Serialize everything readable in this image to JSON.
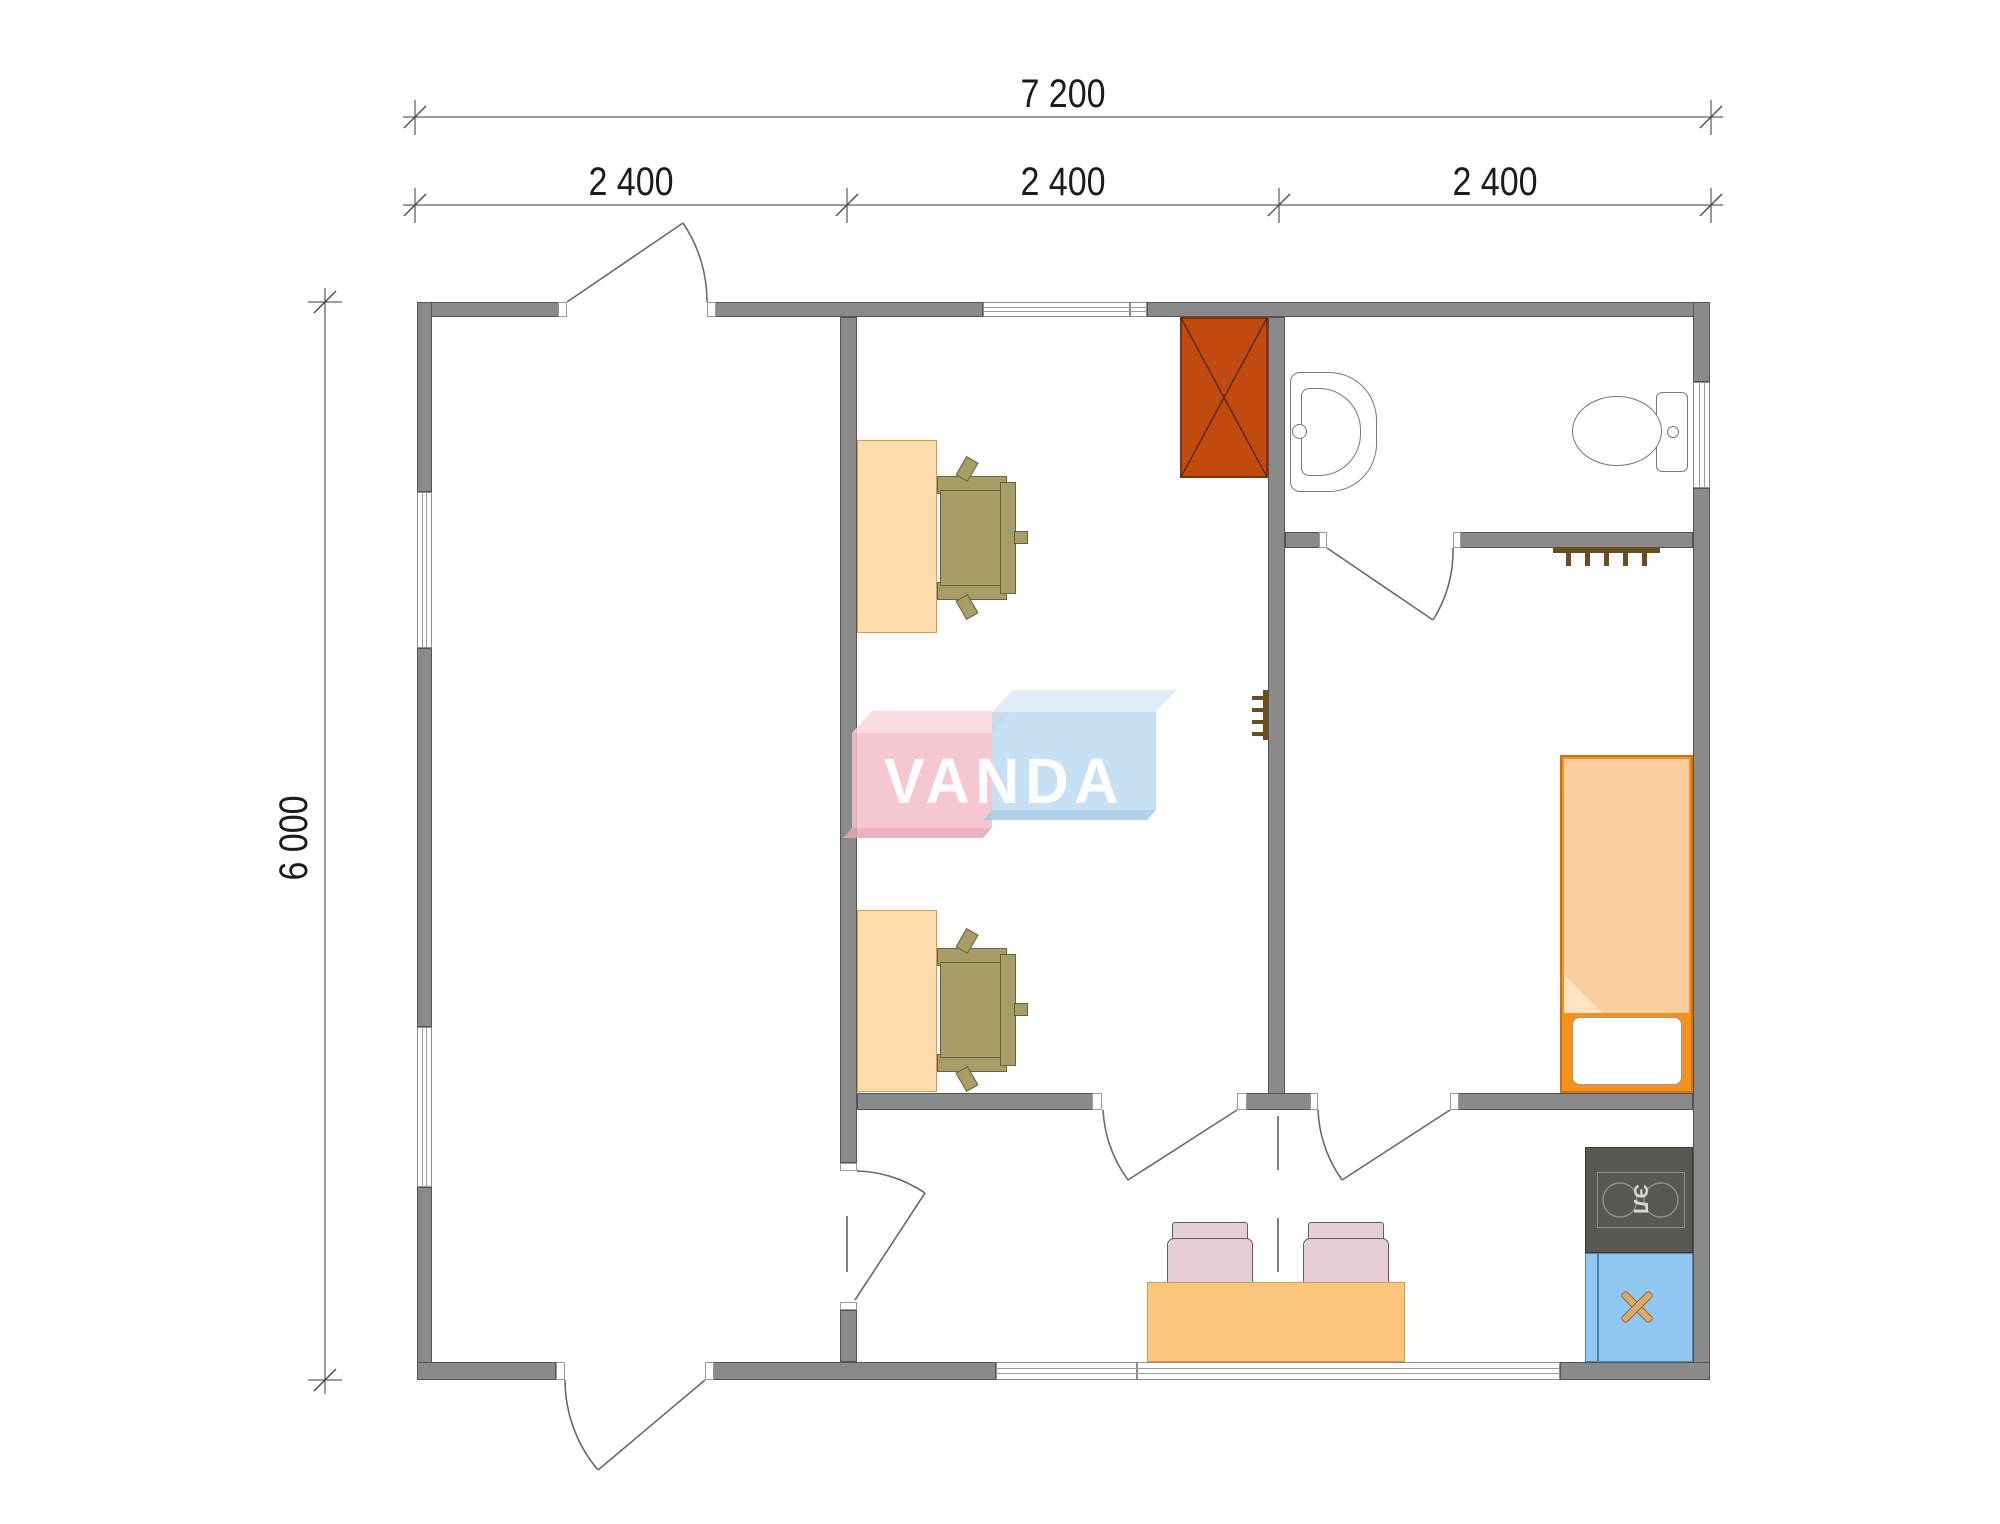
{
  "dimensions": {
    "overall_width": "7 200",
    "bay_1": "2 400",
    "bay_2": "2 400",
    "bay_3": "2 400",
    "overall_height": "6 000"
  },
  "logo": {
    "text": "VANDA",
    "pink": "#F3BDC9",
    "blue": "#BEDAF2"
  },
  "kitchen": {
    "stove_label": "ЭЛ"
  },
  "colors": {
    "wall": "#8A8A8A",
    "wardrobe": "#C14B0E",
    "desk": "#FCDCAB",
    "chair": "#A79D66",
    "bed_frame": "#F5921E",
    "blanket": "#FBCF9D",
    "table": "#FBC57E",
    "dining_chair": "#E6CED6",
    "stove": "#5B5753",
    "sink_cabinet": "#90C8F2"
  },
  "geometry": {
    "rects": [
      {
        "n": "top-wall-left",
        "c": "wall",
        "x": 417,
        "y": 302,
        "w": 150,
        "h": 15
      },
      {
        "n": "top-wall-mid",
        "c": "wall",
        "x": 707,
        "y": 302,
        "w": 276,
        "h": 15
      },
      {
        "n": "top-wall-right",
        "c": "wall",
        "x": 1147,
        "y": 302,
        "w": 563,
        "h": 15
      },
      {
        "n": "left-wall-top",
        "c": "wall",
        "x": 417,
        "y": 302,
        "w": 15,
        "h": 190
      },
      {
        "n": "left-wall-mid",
        "c": "wall",
        "x": 417,
        "y": 648,
        "w": 15,
        "h": 379
      },
      {
        "n": "left-wall-bottom",
        "c": "wall",
        "x": 417,
        "y": 1187,
        "w": 15,
        "h": 193
      },
      {
        "n": "right-wall-top",
        "c": "wall",
        "x": 1693,
        "y": 302,
        "w": 17,
        "h": 80
      },
      {
        "n": "right-wall-main",
        "c": "wall",
        "x": 1693,
        "y": 488,
        "w": 17,
        "h": 892
      },
      {
        "n": "bottom-wall-left",
        "c": "wall",
        "x": 417,
        "y": 1362,
        "w": 139,
        "h": 18
      },
      {
        "n": "bottom-wall-mid",
        "c": "wall",
        "x": 705,
        "y": 1362,
        "w": 291,
        "h": 18
      },
      {
        "n": "bottom-wall-right",
        "c": "wall",
        "x": 1560,
        "y": 1362,
        "w": 150,
        "h": 18
      },
      {
        "n": "hall-partition-wall",
        "c": "wall",
        "x": 840,
        "y": 317,
        "w": 17,
        "h": 846
      },
      {
        "n": "hall-partition-stub",
        "c": "wall",
        "x": 840,
        "y": 1310,
        "w": 17,
        "h": 52
      },
      {
        "n": "bedroom-partition-wall",
        "c": "wall",
        "x": 1268,
        "y": 317,
        "w": 17,
        "h": 793
      },
      {
        "n": "mid-wall-left",
        "c": "wall",
        "x": 857,
        "y": 1093,
        "w": 245,
        "h": 17
      },
      {
        "n": "mid-wall-center",
        "c": "wall",
        "x": 1237,
        "y": 1093,
        "w": 81,
        "h": 17
      },
      {
        "n": "mid-wall-right",
        "c": "wall",
        "x": 1450,
        "y": 1093,
        "w": 243,
        "h": 17
      },
      {
        "n": "bath-wall-left",
        "c": "wall",
        "x": 1285,
        "y": 532,
        "w": 42,
        "h": 16
      },
      {
        "n": "bath-wall-right",
        "c": "wall",
        "x": 1453,
        "y": 532,
        "w": 240,
        "h": 16
      },
      {
        "n": "top-window",
        "c": "window-h",
        "x": 983,
        "y": 302,
        "w": 147,
        "h": 15
      },
      {
        "n": "top-window-end",
        "c": "window-h",
        "x": 1130,
        "y": 302,
        "w": 17,
        "h": 15
      },
      {
        "n": "left-window-1",
        "c": "window-v",
        "x": 417,
        "y": 492,
        "w": 15,
        "h": 156
      },
      {
        "n": "left-window-2",
        "c": "window-v",
        "x": 417,
        "y": 1027,
        "w": 15,
        "h": 160
      },
      {
        "n": "right-window",
        "c": "window-v",
        "x": 1693,
        "y": 382,
        "w": 17,
        "h": 106
      },
      {
        "n": "bottom-window-left",
        "c": "window-h",
        "x": 996,
        "y": 1362,
        "w": 141,
        "h": 18
      },
      {
        "n": "bottom-window-right",
        "c": "window-h",
        "x": 1137,
        "y": 1362,
        "w": 423,
        "h": 18
      },
      {
        "n": "door-jamb",
        "c": "jamb",
        "x": 558,
        "y": 302,
        "w": 9,
        "h": 15
      },
      {
        "n": "door-jamb",
        "c": "jamb",
        "x": 707,
        "y": 302,
        "w": 9,
        "h": 15
      },
      {
        "n": "door-jamb",
        "c": "jamb",
        "x": 556,
        "y": 1362,
        "w": 9,
        "h": 18
      },
      {
        "n": "door-jamb",
        "c": "jamb",
        "x": 705,
        "y": 1362,
        "w": 9,
        "h": 18
      },
      {
        "n": "door-jamb",
        "c": "jamb",
        "x": 840,
        "y": 1163,
        "w": 17,
        "h": 8
      },
      {
        "n": "door-jamb",
        "c": "jamb",
        "x": 840,
        "y": 1302,
        "w": 17,
        "h": 8
      },
      {
        "n": "door-jamb",
        "c": "jamb",
        "x": 1092,
        "y": 1093,
        "w": 10,
        "h": 17
      },
      {
        "n": "door-jamb",
        "c": "jamb",
        "x": 1237,
        "y": 1093,
        "w": 10,
        "h": 17
      },
      {
        "n": "door-jamb",
        "c": "jamb",
        "x": 1310,
        "y": 1093,
        "w": 8,
        "h": 17
      },
      {
        "n": "door-jamb",
        "c": "jamb",
        "x": 1450,
        "y": 1093,
        "w": 9,
        "h": 17
      },
      {
        "n": "door-jamb",
        "c": "jamb",
        "x": 1319,
        "y": 532,
        "w": 8,
        "h": 16
      },
      {
        "n": "door-jamb",
        "c": "jamb",
        "x": 1453,
        "y": 532,
        "w": 8,
        "h": 16
      },
      {
        "n": "wardrobe",
        "c": "wardrobe",
        "x": 1180,
        "y": 317,
        "w": 88,
        "h": 161
      },
      {
        "n": "desk-1",
        "c": "desk",
        "x": 857,
        "y": 440,
        "w": 80,
        "h": 193
      },
      {
        "n": "desk-2",
        "c": "desk",
        "x": 857,
        "y": 910,
        "w": 80,
        "h": 182
      },
      {
        "n": "chair-1-armrest-top",
        "c": "chairp",
        "x": 937,
        "y": 476,
        "w": 70,
        "h": 18
      },
      {
        "n": "chair-1-armrest-bottom",
        "c": "chairp",
        "x": 937,
        "y": 582,
        "w": 70,
        "h": 18
      },
      {
        "n": "chair-1-seat",
        "c": "chairp",
        "x": 940,
        "y": 490,
        "w": 62,
        "h": 96
      },
      {
        "n": "chair-1-backrest",
        "c": "chairp",
        "x": 1000,
        "y": 482,
        "w": 16,
        "h": 112
      },
      {
        "n": "chair-1-leg",
        "c": "chairp",
        "x": 960,
        "y": 458,
        "w": 14,
        "h": 22,
        "r": 30
      },
      {
        "n": "chair-1-leg",
        "c": "chairp",
        "x": 960,
        "y": 596,
        "w": 14,
        "h": 22,
        "r": -30
      },
      {
        "n": "chair-1-leg",
        "c": "chairp",
        "x": 1014,
        "y": 531,
        "w": 14,
        "h": 13
      },
      {
        "n": "chair-2-armrest-top",
        "c": "chairp",
        "x": 937,
        "y": 948,
        "w": 70,
        "h": 18
      },
      {
        "n": "chair-2-armrest-bottom",
        "c": "chairp",
        "x": 937,
        "y": 1054,
        "w": 70,
        "h": 18
      },
      {
        "n": "chair-2-seat",
        "c": "chairp",
        "x": 940,
        "y": 962,
        "w": 62,
        "h": 96
      },
      {
        "n": "chair-2-backrest",
        "c": "chairp",
        "x": 1000,
        "y": 954,
        "w": 16,
        "h": 112
      },
      {
        "n": "chair-2-leg",
        "c": "chairp",
        "x": 960,
        "y": 930,
        "w": 14,
        "h": 22,
        "r": 30
      },
      {
        "n": "chair-2-leg",
        "c": "chairp",
        "x": 960,
        "y": 1068,
        "w": 14,
        "h": 22,
        "r": -30
      },
      {
        "n": "chair-2-leg",
        "c": "chairp",
        "x": 1014,
        "y": 1003,
        "w": 14,
        "h": 13
      },
      {
        "n": "bed-frame",
        "c": "bedframe",
        "x": 1560,
        "y": 755,
        "w": 133,
        "h": 338
      },
      {
        "n": "bed-blanket",
        "c": "blanket",
        "x": 1564,
        "y": 759,
        "w": 125,
        "h": 254,
        "cp": "polygon(0 0,100% 0,100% 100%,24% 100%,0 85%)"
      },
      {
        "n": "bed-blanket-fold",
        "c": "flap",
        "x": 1564,
        "y": 975,
        "w": 38,
        "h": 38,
        "cp": "polygon(0 0,100% 100%,0 100%)"
      },
      {
        "n": "bed-pillow",
        "c": "pillow",
        "x": 1572,
        "y": 1017,
        "w": 110,
        "h": 68
      },
      {
        "n": "dining-chair-1-backrest",
        "c": "dcback",
        "x": 1172,
        "y": 1222,
        "w": 76,
        "h": 20
      },
      {
        "n": "dining-chair-1-seat",
        "c": "dcseat",
        "x": 1167,
        "y": 1238,
        "w": 86,
        "h": 46
      },
      {
        "n": "dining-chair-2-backrest",
        "c": "dcback",
        "x": 1308,
        "y": 1222,
        "w": 76,
        "h": 20
      },
      {
        "n": "dining-chair-2-seat",
        "c": "dcseat",
        "x": 1303,
        "y": 1238,
        "w": 86,
        "h": 46
      },
      {
        "n": "dining-table",
        "c": "table",
        "x": 1147,
        "y": 1282,
        "w": 258,
        "h": 80
      },
      {
        "n": "stove",
        "c": "stove",
        "x": 1585,
        "y": 1147,
        "w": 108,
        "h": 106
      },
      {
        "n": "stove-panel",
        "c": "stpanel",
        "x": 1597,
        "y": 1172,
        "w": 88,
        "h": 56
      },
      {
        "n": "sink-cabinet",
        "c": "bluecab",
        "x": 1585,
        "y": 1253,
        "w": 108,
        "h": 109
      },
      {
        "n": "sink-cabinet-divider",
        "c": "bluediv",
        "x": 1597,
        "y": 1254,
        "w": 2,
        "h": 107
      },
      {
        "n": "sink-x-mark",
        "c": "xbar",
        "x": 1617,
        "y": 1303,
        "w": 40,
        "h": 8,
        "r": 45
      },
      {
        "n": "sink-x-mark",
        "c": "xbar",
        "x": 1617,
        "y": 1303,
        "w": 40,
        "h": 8,
        "r": -45
      },
      {
        "n": "bath-sink",
        "c": "fixture",
        "x": 1290,
        "y": 372,
        "w": 87,
        "h": 120,
        "br": "10px 48px 48px 10px"
      },
      {
        "n": "bath-sink-basin",
        "c": "fixline",
        "x": 1301,
        "y": 388,
        "w": 60,
        "h": 88,
        "br": "8px 42px 42px 8px"
      },
      {
        "n": "bath-sink-tap",
        "c": "fixture",
        "x": 1292,
        "y": 424,
        "w": 15,
        "h": 15,
        "br": "50%"
      },
      {
        "n": "toilet-tank",
        "c": "fixture",
        "x": 1656,
        "y": 392,
        "w": 32,
        "h": 80,
        "br": "6px"
      },
      {
        "n": "toilet-bowl",
        "c": "fixture",
        "x": 1572,
        "y": 396,
        "w": 90,
        "h": 70,
        "br": "50%"
      },
      {
        "n": "toilet-button",
        "c": "fixture",
        "x": 1667,
        "y": 426,
        "w": 12,
        "h": 12,
        "br": "50%"
      },
      {
        "n": "bedroom-hanger-bar",
        "c": "hanger",
        "x": 1553,
        "y": 547,
        "w": 107,
        "h": 6
      },
      {
        "n": "bedroom-hanger-hook",
        "c": "hanger",
        "x": 1566,
        "y": 553,
        "w": 5,
        "h": 13
      },
      {
        "n": "bedroom-hanger-hook",
        "c": "hanger",
        "x": 1585,
        "y": 553,
        "w": 5,
        "h": 13
      },
      {
        "n": "bedroom-hanger-hook",
        "c": "hanger",
        "x": 1604,
        "y": 553,
        "w": 5,
        "h": 13
      },
      {
        "n": "bedroom-hanger-hook",
        "c": "hanger",
        "x": 1623,
        "y": 553,
        "w": 5,
        "h": 13
      },
      {
        "n": "bedroom-hanger-hook",
        "c": "hanger",
        "x": 1642,
        "y": 553,
        "w": 5,
        "h": 13
      },
      {
        "n": "office-hanger-bar",
        "c": "hanger",
        "x": 1263,
        "y": 690,
        "w": 5,
        "h": 50
      },
      {
        "n": "office-hanger-hook",
        "c": "hanger",
        "x": 1252,
        "y": 696,
        "w": 11,
        "h": 4
      },
      {
        "n": "office-hanger-hook",
        "c": "hanger",
        "x": 1252,
        "y": 708,
        "w": 11,
        "h": 4
      },
      {
        "n": "office-hanger-hook",
        "c": "hanger",
        "x": 1252,
        "y": 720,
        "w": 11,
        "h": 4
      },
      {
        "n": "office-hanger-hook",
        "c": "hanger",
        "x": 1252,
        "y": 732,
        "w": 11,
        "h": 4
      }
    ],
    "svg_lines": [
      {
        "n": "dim-line-total-width",
        "x1": 403,
        "y1": 117,
        "x2": 1723,
        "y2": 117,
        "s": "#3a3a3a",
        "w": 1
      },
      {
        "n": "dim-line-bays",
        "x1": 403,
        "y1": 205,
        "x2": 1723,
        "y2": 205,
        "s": "#3a3a3a",
        "w": 1
      },
      {
        "n": "dim-line-height",
        "x1": 325,
        "y1": 288,
        "x2": 325,
        "y2": 1394,
        "s": "#3a3a3a",
        "w": 1
      },
      {
        "n": "dim-ext",
        "x1": 415,
        "y1": 100,
        "x2": 415,
        "y2": 135,
        "s": "#3a3a3a",
        "w": 1
      },
      {
        "n": "dim-ext",
        "x1": 1711,
        "y1": 100,
        "x2": 1711,
        "y2": 135,
        "s": "#3a3a3a",
        "w": 1
      },
      {
        "n": "dim-ext",
        "x1": 415,
        "y1": 188,
        "x2": 415,
        "y2": 223,
        "s": "#3a3a3a",
        "w": 1
      },
      {
        "n": "dim-ext",
        "x1": 847,
        "y1": 188,
        "x2": 847,
        "y2": 223,
        "s": "#3a3a3a",
        "w": 1
      },
      {
        "n": "dim-ext",
        "x1": 1279,
        "y1": 188,
        "x2": 1279,
        "y2": 223,
        "s": "#3a3a3a",
        "w": 1
      },
      {
        "n": "dim-ext",
        "x1": 1711,
        "y1": 188,
        "x2": 1711,
        "y2": 223,
        "s": "#3a3a3a",
        "w": 1
      },
      {
        "n": "dim-ext",
        "x1": 308,
        "y1": 302,
        "x2": 342,
        "y2": 302,
        "s": "#3a3a3a",
        "w": 1
      },
      {
        "n": "dim-ext",
        "x1": 308,
        "y1": 1380,
        "x2": 342,
        "y2": 1380,
        "s": "#3a3a3a",
        "w": 1
      },
      {
        "n": "dim-tick",
        "x1": 404,
        "y1": 128,
        "x2": 426,
        "y2": 106,
        "s": "#444",
        "w": 1.3
      },
      {
        "n": "dim-tick",
        "x1": 1700,
        "y1": 128,
        "x2": 1722,
        "y2": 106,
        "s": "#444",
        "w": 1.3
      },
      {
        "n": "dim-tick",
        "x1": 404,
        "y1": 216,
        "x2": 426,
        "y2": 194,
        "s": "#444",
        "w": 1.3
      },
      {
        "n": "dim-tick",
        "x1": 836,
        "y1": 216,
        "x2": 858,
        "y2": 194,
        "s": "#444",
        "w": 1.3
      },
      {
        "n": "dim-tick",
        "x1": 1268,
        "y1": 216,
        "x2": 1290,
        "y2": 194,
        "s": "#444",
        "w": 1.3
      },
      {
        "n": "dim-tick",
        "x1": 1700,
        "y1": 216,
        "x2": 1722,
        "y2": 194,
        "s": "#444",
        "w": 1.3
      },
      {
        "n": "dim-tick",
        "x1": 314,
        "y1": 313,
        "x2": 336,
        "y2": 291,
        "s": "#444",
        "w": 1.3
      },
      {
        "n": "dim-tick",
        "x1": 314,
        "y1": 1391,
        "x2": 336,
        "y2": 1369,
        "s": "#444",
        "w": 1.3
      },
      {
        "n": "opening-dash",
        "x1": 1278,
        "y1": 1116,
        "x2": 1278,
        "y2": 1170,
        "s": "#555",
        "w": 1.5
      },
      {
        "n": "opening-dash",
        "x1": 1278,
        "y1": 1218,
        "x2": 1278,
        "y2": 1272,
        "s": "#555",
        "w": 1.5
      },
      {
        "n": "opening-dash",
        "x1": 847,
        "y1": 1216,
        "x2": 847,
        "y2": 1272,
        "s": "#555",
        "w": 1.5
      },
      {
        "n": "wardrobe-cross",
        "x1": 1181,
        "y1": 318,
        "x2": 1267,
        "y2": 477,
        "s": "#40210a",
        "w": 1.2
      },
      {
        "n": "wardrobe-cross",
        "x1": 1267,
        "y1": 318,
        "x2": 1181,
        "y2": 477,
        "s": "#40210a",
        "w": 1.2
      }
    ],
    "svg_paths": [
      {
        "n": "door-leaf-entry-top",
        "d": "M567,302 L683,223",
        "s": "#6a6a6a",
        "w": 1.6
      },
      {
        "n": "door-arc-entry-top",
        "d": "M683,223 A140,140 0 0 1 707,302",
        "s": "#6a6a6a",
        "w": 1.6
      },
      {
        "n": "door-leaf-entry-bottom",
        "d": "M705,1380 L598,1470",
        "s": "#6a6a6a",
        "w": 1.6
      },
      {
        "n": "door-arc-entry-bottom",
        "d": "M565,1380 A140,140 0 0 0 598,1470",
        "s": "#6a6a6a",
        "w": 1.6
      },
      {
        "n": "door-leaf-hall",
        "d": "M855,1300 L925,1193",
        "s": "#6a6a6a",
        "w": 1.6
      },
      {
        "n": "door-arc-hall",
        "d": "M857,1171 A129,129 0 0 1 925,1193",
        "s": "#6a6a6a",
        "w": 1.6
      },
      {
        "n": "door-leaf-office",
        "d": "M1237,1110 L1128,1180",
        "s": "#6a6a6a",
        "w": 1.6
      },
      {
        "n": "door-arc-office",
        "d": "M1103,1110 A132,132 0 0 0 1128,1180",
        "s": "#6a6a6a",
        "w": 1.6
      },
      {
        "n": "door-leaf-bedroom",
        "d": "M1450,1110 L1342,1180",
        "s": "#6a6a6a",
        "w": 1.6
      },
      {
        "n": "door-arc-bedroom",
        "d": "M1318,1110 A132,132 0 0 0 1342,1180",
        "s": "#6a6a6a",
        "w": 1.6
      },
      {
        "n": "door-leaf-bathroom",
        "d": "M1327,548 L1433,620",
        "s": "#6a6a6a",
        "w": 1.6
      },
      {
        "n": "door-arc-bathroom",
        "d": "M1433,620 A128,128 0 0 0 1453,548",
        "s": "#6a6a6a",
        "w": 1.6
      },
      {
        "n": "logo-pink-top",
        "d": "M852,733 L872,711 L1012,711 L992,733 Z",
        "f": "#F7D6DD",
        "o": 0.85
      },
      {
        "n": "logo-pink-front",
        "d": "M852,733 L992,733 L992,828 L852,828 Z",
        "f": "#F3BDC9",
        "o": 0.85
      },
      {
        "n": "logo-pink-bottom",
        "d": "M852,828 L992,828 L983,838 L843,838 Z",
        "f": "#E8A7B6",
        "o": 0.85
      },
      {
        "n": "logo-blue-top",
        "d": "M992,712 L1013,690 L1177,690 L1156,712 Z",
        "f": "#DAEAF8",
        "o": 0.85
      },
      {
        "n": "logo-blue-front",
        "d": "M992,712 L1156,712 L1156,810 L992,810 Z",
        "f": "#BEDAF2",
        "o": 0.85
      },
      {
        "n": "logo-blue-bottom",
        "d": "M992,810 L1156,810 L1147,820 L983,820 Z",
        "f": "#A6C9E8",
        "o": 0.85
      }
    ],
    "svg_circles": [
      {
        "n": "stove-burner",
        "cx": 1620,
        "cy": 1200,
        "r": 17,
        "s": "#908D86",
        "w": 1.5
      },
      {
        "n": "stove-burner",
        "cx": 1661,
        "cy": 1200,
        "r": 17,
        "s": "#908D86",
        "w": 1.5
      }
    ]
  }
}
